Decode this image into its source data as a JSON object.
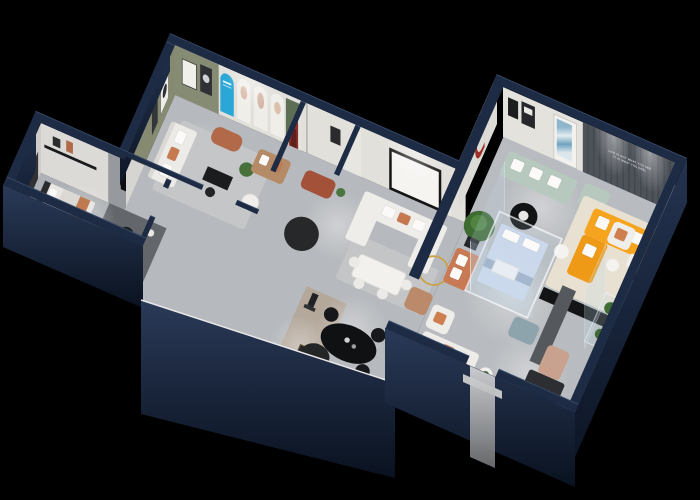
{
  "scene": {
    "title": "Isometric 3D cutaway render of a furniture showroom floor plan on black background",
    "background_color": "#000000",
    "palette": {
      "exterior_wall": "#1e2b44",
      "wall_face_light": "#e2e0db",
      "floor": "#b7babe",
      "olive_wall": "#868b74",
      "poster_blue": "#2aa7d6",
      "arch_red": "#8c3029",
      "u_column_red": "#7e2b22",
      "copper_bench": "#b2694a",
      "orange_sofa": "#f6a41e",
      "mint_sofa": "#b7c9be",
      "pale_blue_bed": "#cbd8eb",
      "terracotta": "#c87a55",
      "tan_sofa": "#b58a66",
      "slat_wall": "#484d54",
      "glass": "rgba(195,220,238,0.2)",
      "teddy_brown": "#7a4a33",
      "plant_green": "#47703a"
    },
    "feature_wall": {
      "slogan_line1": "LIFE IS NOT WHAT YOU SEE",
      "slogan_line2": "IT IS WHAT YOU FEEL"
    },
    "rooms": [
      {
        "id": "gallery",
        "label": "gallery lounge",
        "features": [
          "olive accent wall with framed art",
          "blue arched poster",
          "three white arched posters",
          "green door",
          "white sofa",
          "copper ottoman",
          "black writing desk",
          "tan loveseat",
          "plant"
        ]
      },
      {
        "id": "foyer",
        "label": "arch foyer",
        "features": [
          "dark red arch doorway",
          "copper bench",
          "round black rug"
        ]
      },
      {
        "id": "living",
        "label": "white living vignette",
        "features": [
          "large black wall frame",
          "white U sectional sofa",
          "white dining table with chairs",
          "brass ring floor lamp",
          "tan armchair"
        ]
      },
      {
        "id": "bedroom-annex",
        "label": "bedroom and media room",
        "features": [
          "bed with orange throw",
          "black shelf",
          "long black sideboard",
          "round black chair"
        ]
      },
      {
        "id": "dining-corridor",
        "label": "open dining corridor",
        "features": [
          "black oval dining table",
          "black chairs",
          "bar cart",
          "sculpture figure",
          "black round rug",
          "wood runner"
        ]
      },
      {
        "id": "u-column",
        "label": "white column with dark red U arch",
        "features": [
          "potted tree",
          "white armchair with orange pillow",
          "terracotta sofa"
        ]
      },
      {
        "id": "glass-room",
        "label": "glass display box",
        "features": [
          "pale blue tufted bed",
          "white pillows",
          "white coffee table"
        ]
      },
      {
        "id": "showroom",
        "label": "main showroom",
        "features": [
          "mint green sofa and ottoman",
          "blue abstract art",
          "black round coffee table",
          "dark slat feature wall with slogan",
          "orange L-shaped sectional",
          "black media bench",
          "white armchair",
          "teddy bear figure",
          "white desk",
          "gray mirror partition",
          "blush recliner",
          "blue-gray ottoman",
          "glass terrarium with plants",
          "entry mirror strip"
        ]
      }
    ]
  }
}
